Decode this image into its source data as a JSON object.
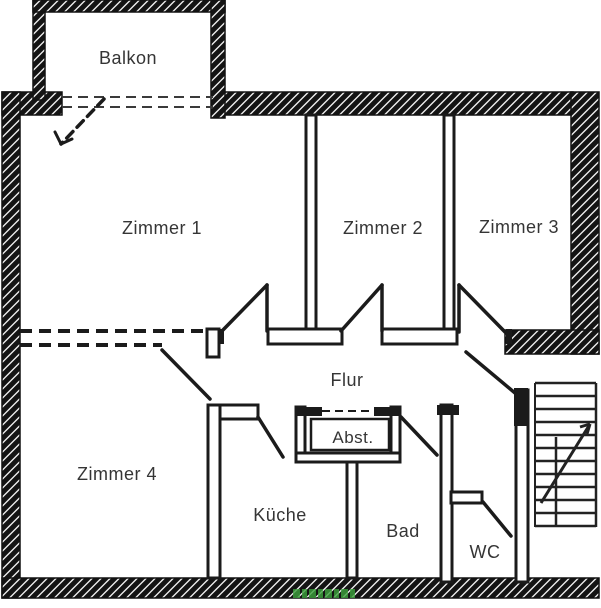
{
  "diagram": {
    "type": "floor-plan",
    "background_color": "#ffffff",
    "wall_ink_color": "#1b1b1b",
    "label_color": "#353535",
    "watermark_color": "#3da23d",
    "rooms": [
      {
        "id": "balkon",
        "label": "Balkon"
      },
      {
        "id": "zimmer1",
        "label": "Zimmer 1"
      },
      {
        "id": "zimmer2",
        "label": "Zimmer 2"
      },
      {
        "id": "zimmer3",
        "label": "Zimmer 3"
      },
      {
        "id": "flur",
        "label": "Flur"
      },
      {
        "id": "zimmer4",
        "label": "Zimmer 4"
      },
      {
        "id": "abst",
        "label": "Abst."
      },
      {
        "id": "kueche",
        "label": "Küche"
      },
      {
        "id": "bad",
        "label": "Bad"
      },
      {
        "id": "wc",
        "label": "WC"
      }
    ],
    "features": [
      "hatched-masonry-outer-walls",
      "balcony-door-dashed-swing",
      "room-door-swings",
      "apartment-entrance-door",
      "storage-closet-double-wall",
      "staircase-with-direction-arrow",
      "green-watermark"
    ]
  }
}
